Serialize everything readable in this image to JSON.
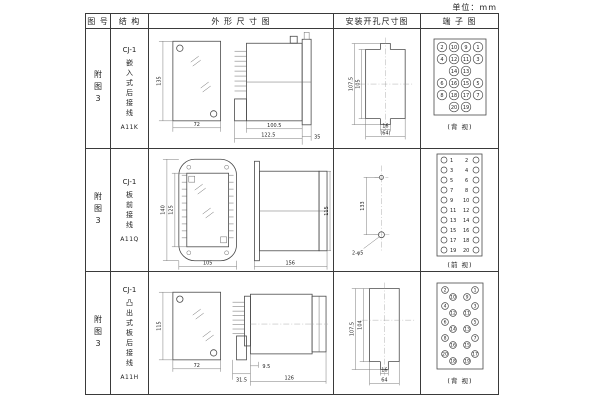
{
  "unit_label": "单位：mm",
  "header": {
    "col_figure": "图 号",
    "col_structure": "结 构",
    "col_outline": "外 形 尺 寸 图",
    "col_install": "安装开孔尺寸图",
    "col_terminal": "端 子 图"
  },
  "rows": [
    {
      "figure_no": "附图3",
      "model": "CJ-1",
      "desc": "嵌入式后接线",
      "code": "A11K",
      "outline": {
        "front_h": "135",
        "front_w": "72",
        "side_d1": "100.5",
        "side_d2": "122.5",
        "side_d3": "35"
      },
      "install": {
        "v_outer": "107.5",
        "v_inner": "105",
        "h_inner": "16",
        "h_outer": "(64)"
      },
      "terminal": {
        "caption": "(背 视)",
        "grid": [
          [
            "2",
            "10",
            "9",
            "1"
          ],
          [
            "4",
            "12",
            "11",
            "3"
          ],
          [
            "",
            "14",
            "13",
            ""
          ],
          [
            "6",
            "16",
            "15",
            "5"
          ],
          [
            "8",
            "18",
            "17",
            "7"
          ],
          [
            "",
            "20",
            "19",
            ""
          ]
        ]
      }
    },
    {
      "figure_no": "附图3",
      "model": "CJ-1",
      "desc": "板前接线",
      "code": "A11Q",
      "outline": {
        "front_h_outer": "140",
        "front_h_inner": "125",
        "front_w": "105",
        "side_len": "156",
        "side_h": "115"
      },
      "install": {
        "v": "133",
        "hole_label": "2-φ5"
      },
      "terminal": {
        "caption": "(前 视)",
        "left": [
          "1",
          "3",
          "5",
          "7",
          "9",
          "11",
          "13",
          "15",
          "17",
          "19"
        ],
        "right": [
          "2",
          "4",
          "6",
          "8",
          "10",
          "12",
          "14",
          "16",
          "18",
          "20"
        ]
      }
    },
    {
      "figure_no": "附图3",
      "model": "CJ-1",
      "desc": "凸出式板后接线",
      "code": "A11H",
      "outline": {
        "front_h": "115",
        "front_w": "72",
        "side_d1": "31.5",
        "side_d2": "9.5",
        "side_d3": "126"
      },
      "install": {
        "v_outer": "107.5",
        "v_inner": "104",
        "h_inner": "16",
        "h_outer": "64"
      },
      "terminal": {
        "caption": "(背 视)",
        "left_outer": [
          "2",
          "4",
          "6",
          "8",
          "20"
        ],
        "left_inner": [
          "10",
          "12",
          "14",
          "16",
          "18"
        ],
        "right_inner": [
          "9",
          "11",
          "13",
          "15",
          "19"
        ],
        "right_outer": [
          "1",
          "3",
          "5",
          "7",
          "17"
        ]
      }
    }
  ]
}
